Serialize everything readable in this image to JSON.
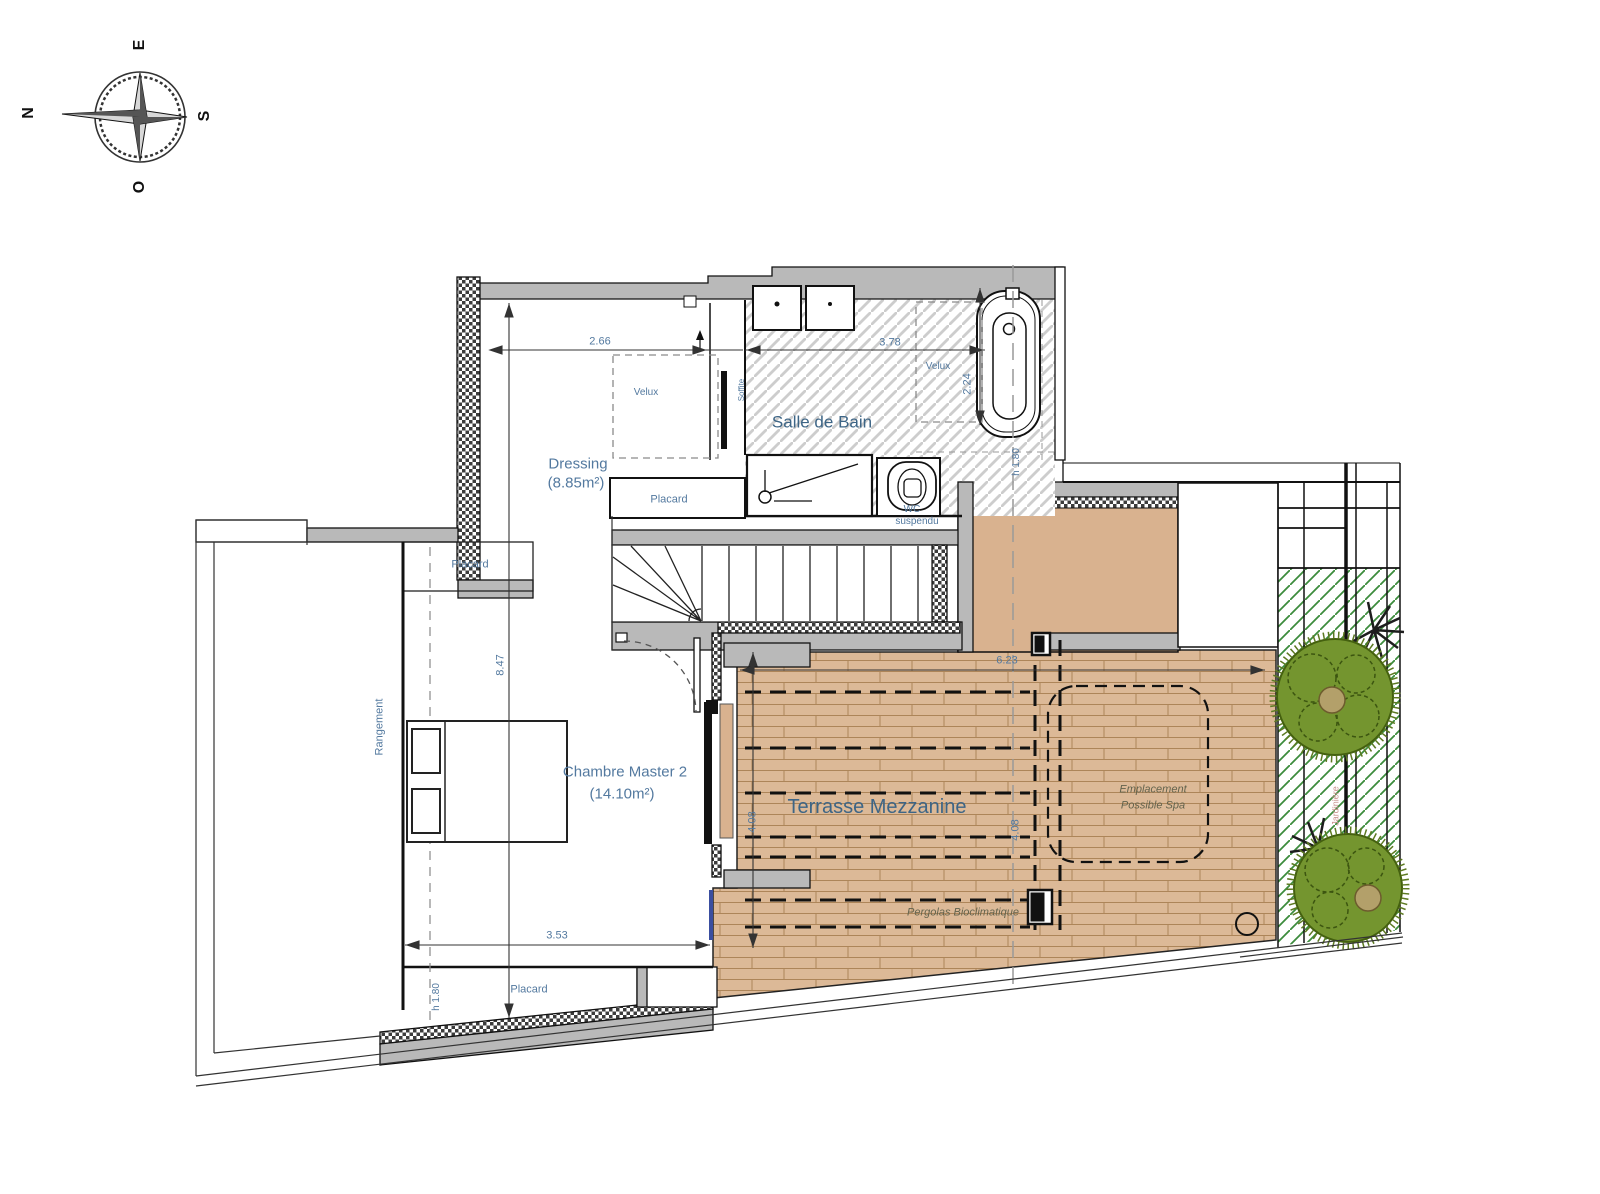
{
  "compass": {
    "top": "E",
    "right": "S",
    "bottom": "O",
    "left": "N"
  },
  "rooms": {
    "salle_de_bain": "Salle de Bain",
    "dressing": "Dressing",
    "dressing_area": "(8.85m²)",
    "chambre": "Chambre Master 2",
    "chambre_area": "(14.10m²)",
    "terrasse": "Terrasse Mezzanine",
    "rangement": "Rangement",
    "jardiniere": "Jardinière"
  },
  "annotations": {
    "velux_dressing": "Velux",
    "velux_bain": "Velux",
    "placard_haut": "Placard",
    "placard_dressing": "Placard",
    "placard_bas": "Placard",
    "wc": "WC",
    "wc_suspendu": "suspendu",
    "soffite": "Soffite",
    "h180_bain": "h 1.80",
    "h180_bas": "h 1.80",
    "spa_l1": "Emplacement",
    "spa_l2": "Possible Spa",
    "pergola": "Pergolas Bioclimatique"
  },
  "dimensions": {
    "dressing_width": "2.66",
    "bain_width": "3.78",
    "velux_depth": "2.24",
    "chambre_length": "8.47",
    "chambre_width": "3.53",
    "terrasse_width": "6.23",
    "terrasse_depth": "4.08",
    "terrasse_depth2": "4.08"
  },
  "colors": {
    "wall_gray": "#b9b9b9",
    "deck_tan": "#dcb997",
    "deck_joint": "#ad8559",
    "solid_tan": "#d9b28f",
    "plant_green": "#74952f",
    "hatch_green": "#3c8c3c",
    "label_blue": "#53799f",
    "annotation_olive": "#63634d",
    "jardiniere_rose": "#c9908c",
    "window_blue": "#3a4ea0"
  }
}
